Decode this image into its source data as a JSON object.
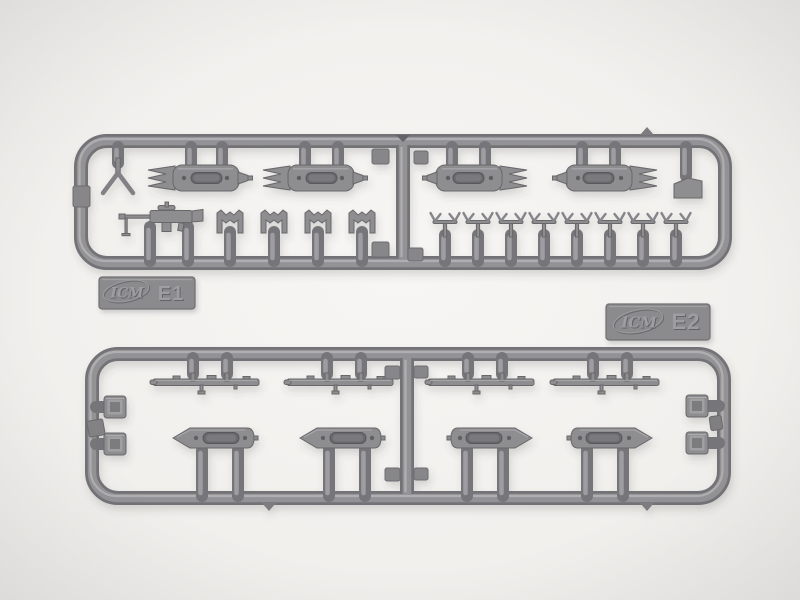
{
  "photo": {
    "subject": "Two gray injection-molded plastic model-kit sprues on a light backdrop",
    "background_color": "#f1efec",
    "plastic_color": "#8e8e91"
  },
  "sprues": [
    {
      "brand": "ICM",
      "label": "E1",
      "parts": [
        "Y-shaped support",
        "torpedo-shaped float (x4)",
        "machine gun",
        "stocked anchor (x4)",
        "V-shaped chock (x8)",
        "small bracket"
      ]
    },
    {
      "brand": "ICM",
      "label": "E2",
      "parts": [
        "gun rail strip (x4)",
        "boat-shaped float (x4)",
        "square box (x4)"
      ]
    }
  ]
}
